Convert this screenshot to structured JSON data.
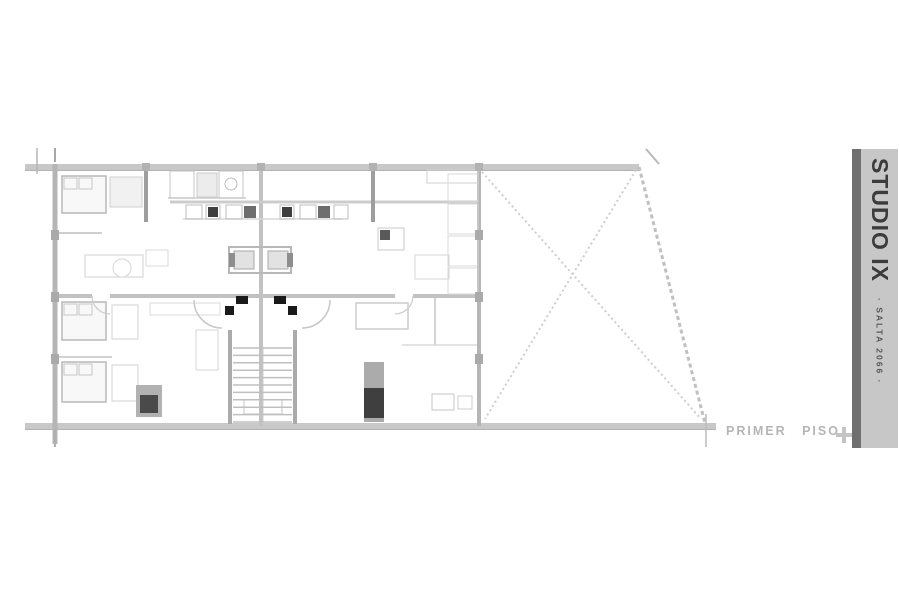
{
  "page": {
    "bg": "#ffffff"
  },
  "titlebar": {
    "title": "STUDIO IX",
    "subtitle": "· SALTA 2066 ·",
    "panel_color": "#c7c7c7",
    "strip_color": "#6f6f6f",
    "text_color": "#3c3c3c"
  },
  "floor_label": {
    "text": "PRIMER PISO",
    "color": "#b5b5b5"
  },
  "plan": {
    "lines": [
      [
        25,
        167,
        639,
        167,
        "#c8c8c8",
        6
      ],
      [
        25,
        170.5,
        639,
        170.5,
        "#b2b2b2",
        1
      ],
      [
        25,
        426,
        716,
        426,
        "#c8c8c8",
        6
      ],
      [
        25,
        429.5,
        716,
        429.5,
        "#b2b2b2",
        1
      ],
      [
        55,
        164,
        55,
        444,
        "#b5b5b5",
        5
      ],
      [
        479,
        168,
        479,
        426,
        "#b5b5b5",
        4
      ],
      [
        261,
        168,
        261,
        426,
        "#c2c2c2",
        4
      ],
      [
        57,
        296,
        92,
        296,
        "#c2c2c2",
        4
      ],
      [
        110,
        296,
        395,
        296,
        "#c2c2c2",
        4
      ],
      [
        413,
        296,
        479,
        296,
        "#c2c2c2",
        4
      ],
      [
        170,
        202,
        477,
        202,
        "#cccccc",
        3
      ],
      [
        146,
        168,
        146,
        222,
        "#9e9e9e",
        4
      ],
      [
        373,
        168,
        373,
        222,
        "#9e9e9e",
        4
      ],
      [
        183,
        219,
        343,
        219,
        "#d6d6d6",
        1.5
      ],
      [
        230,
        330,
        230,
        424,
        "#ababab",
        4
      ],
      [
        295,
        330,
        295,
        424,
        "#ababab",
        4
      ],
      [
        37,
        148,
        37,
        174,
        "#b5b5b5",
        1.5
      ],
      [
        55,
        148,
        55,
        162,
        "#a8a8a8",
        2
      ],
      [
        55,
        429,
        55,
        447,
        "#b0b0b0",
        2
      ],
      [
        706,
        414,
        706,
        447,
        "#bababa",
        1.5
      ],
      [
        646,
        149,
        659,
        164,
        "#b8b8b8",
        2
      ],
      [
        55,
        233,
        102,
        233,
        "#cfcfcf",
        2
      ],
      [
        55,
        357,
        112,
        357,
        "#d2d2d2",
        2
      ],
      [
        435,
        298,
        435,
        345,
        "#d4d4d4",
        2
      ],
      [
        402,
        345,
        477,
        345,
        "#dadada",
        1.5
      ],
      [
        263,
        348,
        263,
        424,
        "#cccccc",
        1
      ],
      [
        168,
        198,
        246,
        198,
        "#cccccc",
        1.5
      ]
    ],
    "dashes": [
      [
        482,
        172,
        701,
        419,
        "#cdcdcd",
        2,
        "2,3"
      ],
      [
        636,
        170,
        485,
        419,
        "#cdcdcd",
        2,
        "2,3"
      ],
      [
        639,
        167,
        705,
        423,
        "#c0c0c0",
        3,
        "4,3"
      ]
    ],
    "rects": [
      [
        62,
        176,
        44,
        37,
        "#b8b8b8",
        "#f8f8f8",
        1.5
      ],
      [
        64,
        178,
        13,
        11,
        "#c6c6c6",
        "none",
        1
      ],
      [
        79,
        178,
        13,
        11,
        "#c6c6c6",
        "none",
        1
      ],
      [
        110,
        177,
        32,
        30,
        "#cfcfcf",
        "#f1f1f1",
        1
      ],
      [
        170,
        171,
        24,
        27,
        "#c4c4c4",
        "none",
        1
      ],
      [
        197,
        173,
        20,
        24,
        "#cacaca",
        "#ececec",
        1
      ],
      [
        219,
        171,
        24,
        27,
        "#c4c4c4",
        "none",
        1
      ],
      [
        186,
        205,
        16,
        14,
        "#bdbdbd",
        "none",
        1
      ],
      [
        206,
        205,
        14,
        14,
        "#bdbdbd",
        "none",
        1
      ],
      [
        208,
        207,
        10,
        10,
        "none",
        "#3f3f3f",
        0
      ],
      [
        226,
        205,
        16,
        14,
        "#bdbdbd",
        "none",
        1
      ],
      [
        244,
        206,
        12,
        12,
        "none",
        "#6e6e6e",
        0
      ],
      [
        280,
        205,
        14,
        14,
        "#bdbdbd",
        "none",
        1
      ],
      [
        282,
        207,
        10,
        10,
        "none",
        "#3f3f3f",
        0
      ],
      [
        300,
        205,
        16,
        14,
        "#bdbdbd",
        "none",
        1
      ],
      [
        318,
        206,
        12,
        12,
        "none",
        "#6e6e6e",
        0
      ],
      [
        334,
        205,
        14,
        14,
        "#bdbdbd",
        "none",
        1
      ],
      [
        427,
        170,
        51,
        13,
        "#d2d2d2",
        "none",
        1
      ],
      [
        378,
        228,
        26,
        22,
        "#cacaca",
        "none",
        1
      ],
      [
        380,
        230,
        10,
        10,
        "none",
        "#5a5a5a",
        0
      ],
      [
        415,
        255,
        34,
        24,
        "#d6d6d6",
        "none",
        1
      ],
      [
        448,
        174,
        30,
        28,
        "#d8d8d8",
        "none",
        1
      ],
      [
        448,
        204,
        30,
        30,
        "#d8d8d8",
        "none",
        1
      ],
      [
        448,
        236,
        30,
        30,
        "#d8d8d8",
        "none",
        1
      ],
      [
        448,
        268,
        30,
        26,
        "#d8d8d8",
        "none",
        1
      ],
      [
        85,
        255,
        58,
        22,
        "#d2d2d2",
        "none",
        1
      ],
      [
        146,
        250,
        22,
        16,
        "#d8d8d8",
        "none",
        1
      ],
      [
        62,
        302,
        44,
        38,
        "#b8b8b8",
        "#f8f8f8",
        1.5
      ],
      [
        64,
        304,
        13,
        11,
        "#c6c6c6",
        "none",
        1
      ],
      [
        79,
        304,
        13,
        11,
        "#c6c6c6",
        "none",
        1
      ],
      [
        62,
        362,
        44,
        40,
        "#b8b8b8",
        "#f8f8f8",
        1.5
      ],
      [
        64,
        364,
        13,
        11,
        "#c6c6c6",
        "none",
        1
      ],
      [
        79,
        364,
        13,
        11,
        "#c6c6c6",
        "none",
        1
      ],
      [
        112,
        305,
        26,
        34,
        "#d2d2d2",
        "none",
        1
      ],
      [
        112,
        365,
        26,
        36,
        "#d2d2d2",
        "none",
        1
      ],
      [
        136,
        385,
        26,
        32,
        "none",
        "#b2b2b2",
        0
      ],
      [
        140,
        395,
        18,
        18,
        "none",
        "#4a4a4a",
        0
      ],
      [
        150,
        303,
        70,
        12,
        "#dadada",
        "none",
        1
      ],
      [
        196,
        330,
        22,
        40,
        "#d6d6d6",
        "none",
        1
      ],
      [
        356,
        303,
        52,
        26,
        "#cccccc",
        "none",
        1.5
      ],
      [
        364,
        362,
        20,
        60,
        "none",
        "#ababab",
        0
      ],
      [
        364,
        388,
        20,
        30,
        "none",
        "#3f3f3f",
        0
      ],
      [
        432,
        394,
        22,
        16,
        "#c4c4c4",
        "none",
        1
      ],
      [
        458,
        396,
        14,
        13,
        "#cccccc",
        "none",
        1
      ],
      [
        229,
        247,
        62,
        26,
        "#b8b8b8",
        "none",
        2
      ],
      [
        234,
        251,
        20,
        18,
        "#aaaaaa",
        "#e2e2e2",
        1
      ],
      [
        268,
        251,
        20,
        18,
        "#aaaaaa",
        "#e2e2e2",
        1
      ],
      [
        229,
        253,
        6,
        14,
        "none",
        "#8e8e8e",
        0
      ],
      [
        287,
        253,
        6,
        14,
        "none",
        "#8e8e8e",
        0
      ],
      [
        236,
        296,
        12,
        8,
        "none",
        "#1a1a1a",
        0
      ],
      [
        274,
        296,
        12,
        8,
        "none",
        "#1a1a1a",
        0
      ],
      [
        225,
        306,
        9,
        9,
        "none",
        "#1a1a1a",
        0
      ],
      [
        288,
        306,
        9,
        9,
        "none",
        "#1a1a1a",
        0
      ],
      [
        244,
        400,
        38,
        14,
        "#c4c4c4",
        "none",
        1
      ],
      [
        51,
        230,
        8,
        10,
        "none",
        "#aaaaaa",
        0
      ],
      [
        51,
        292,
        8,
        10,
        "none",
        "#aaaaaa",
        0
      ],
      [
        51,
        354,
        8,
        10,
        "none",
        "#aaaaaa",
        0
      ],
      [
        475,
        230,
        8,
        10,
        "none",
        "#aaaaaa",
        0
      ],
      [
        475,
        292,
        8,
        10,
        "none",
        "#aaaaaa",
        0
      ],
      [
        475,
        354,
        8,
        10,
        "none",
        "#aaaaaa",
        0
      ],
      [
        142,
        163,
        8,
        8,
        "none",
        "#b2b2b2",
        0
      ],
      [
        257,
        163,
        8,
        8,
        "none",
        "#b2b2b2",
        0
      ],
      [
        369,
        163,
        8,
        8,
        "none",
        "#b2b2b2",
        0
      ],
      [
        475,
        163,
        8,
        8,
        "none",
        "#b2b2b2",
        0
      ]
    ],
    "arcs": [
      [
        "M194,300 A28,28 0 0 0 222,328",
        "#c6c6c6",
        1.5
      ],
      [
        "M330,300 A28,28 0 0 1 302,328",
        "#c6c6c6",
        1.5
      ],
      [
        "M92,296 A18,18 0 0 0 110,314",
        "#cccccc",
        1.2
      ],
      [
        "M413,296 A18,18 0 0 1 395,314",
        "#cccccc",
        1.2
      ]
    ],
    "circles": [
      [
        231,
        184,
        6,
        "#bcbcbc"
      ],
      [
        122,
        268,
        9,
        "#d6d6d6"
      ]
    ],
    "stair": {
      "x1": 233,
      "x2": 292,
      "yStart": 348,
      "yEnd": 422,
      "steps": 11,
      "color": "#bfbfbf",
      "width": 1.5
    },
    "cross_marker": {
      "color": "#c4c4c4"
    }
  }
}
